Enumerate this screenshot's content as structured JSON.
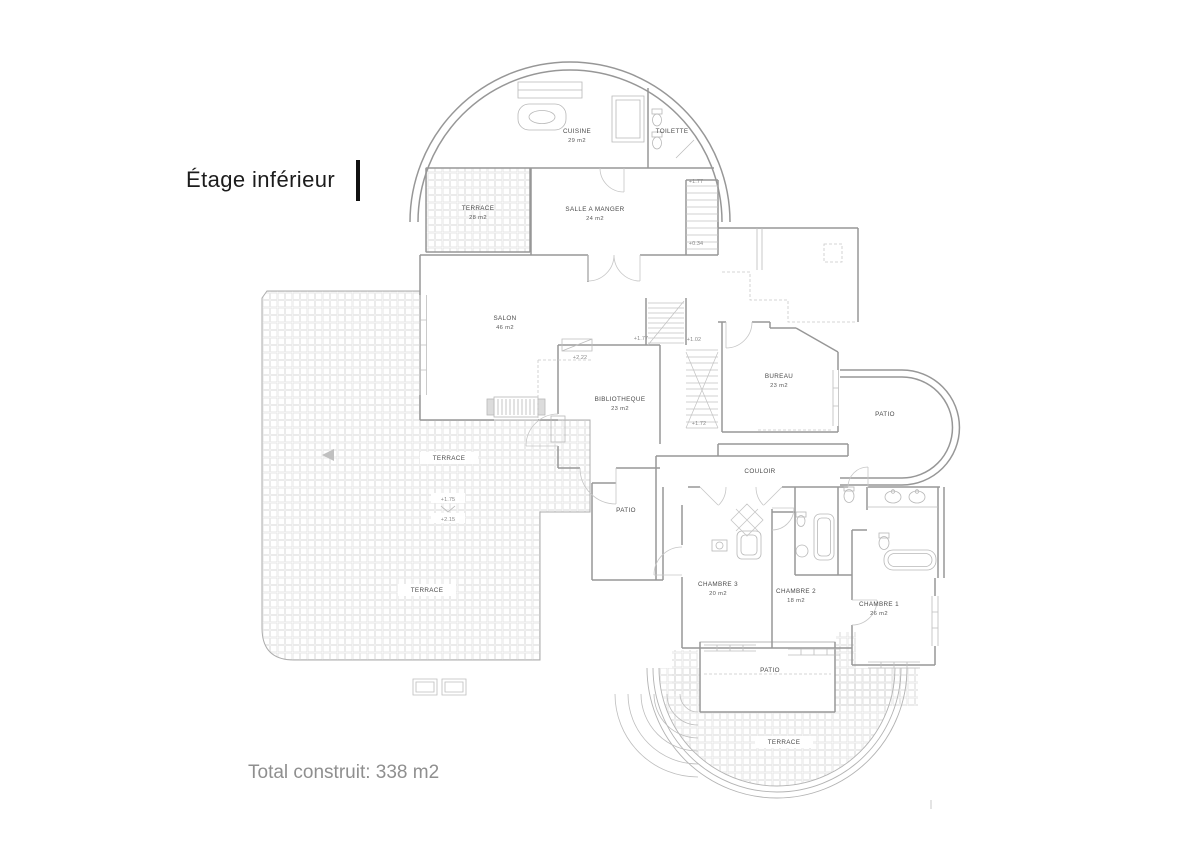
{
  "page": {
    "title": "Étage inférieur",
    "footer": "Total construit: 338 m2"
  },
  "plan": {
    "rooms": [
      {
        "name": "CUISINE",
        "area": "29 m2"
      },
      {
        "name": "TOILETTE",
        "area": ""
      },
      {
        "name": "TERRACE",
        "area": "28 m2"
      },
      {
        "name": "SALLE A MANGER",
        "area": "24 m2"
      },
      {
        "name": "SALON",
        "area": "46 m2"
      },
      {
        "name": "BIBLIOTHEQUE",
        "area": "23 m2"
      },
      {
        "name": "BUREAU",
        "area": "23 m2"
      },
      {
        "name": "PATIO",
        "area": ""
      },
      {
        "name": "COULOIR",
        "area": ""
      },
      {
        "name": "PATIO",
        "area": ""
      },
      {
        "name": "CHAMBRE 3",
        "area": "20 m2"
      },
      {
        "name": "CHAMBRE 2",
        "area": "18 m2"
      },
      {
        "name": "CHAMBRE 1",
        "area": "26 m2"
      },
      {
        "name": "PATIO",
        "area": ""
      },
      {
        "name": "TERRACE",
        "area": ""
      },
      {
        "name": "TERRACE",
        "area": ""
      },
      {
        "name": "TERRACE",
        "area": ""
      }
    ],
    "elevations": [
      "+1.77",
      "+0.34",
      "+2.22",
      "+1.77",
      "+1.02",
      "+1.72",
      "+1.75",
      "+2.15"
    ],
    "colors": {
      "wall": "#979797",
      "tile_line": "#e3e3e3",
      "label_text": "#4a4a4a",
      "footer_text": "#8f8f8f"
    }
  }
}
